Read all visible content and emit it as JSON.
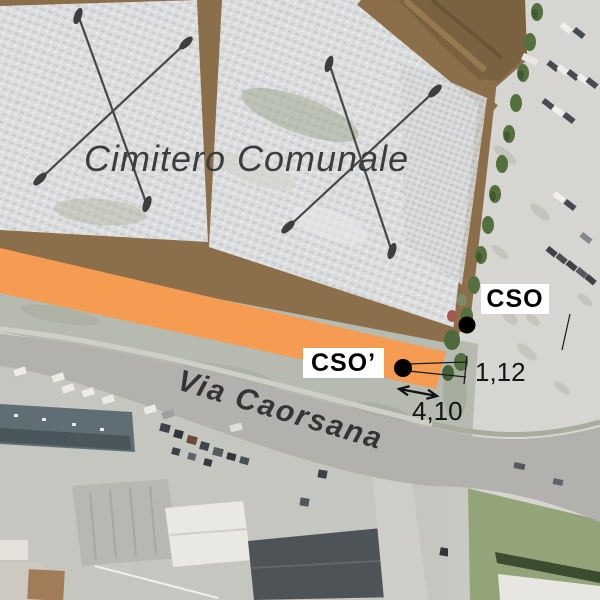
{
  "figure": {
    "type": "annotated-aerial-map",
    "description": "Aerial orthophoto with survey annotations of municipal cemetery and road"
  },
  "labels": {
    "cemetery": "Cimitero Comunale",
    "road": "Via Caorsana"
  },
  "points": {
    "cso": {
      "label": "CSO"
    },
    "cso_prime": {
      "label": "CSO’"
    }
  },
  "dimensions": {
    "offset": "1,12",
    "width": "4,10"
  },
  "colors": {
    "highlight_strip": "#F59B52",
    "cemetery_path_brown": "#8B6F4A",
    "cemetery_block_gray": "#DCDDDE",
    "road_gray": "#B2B1AD",
    "grass_green": "#93A478",
    "annotation_black": "#141414",
    "map_text_gray": "#3D3D3D"
  }
}
